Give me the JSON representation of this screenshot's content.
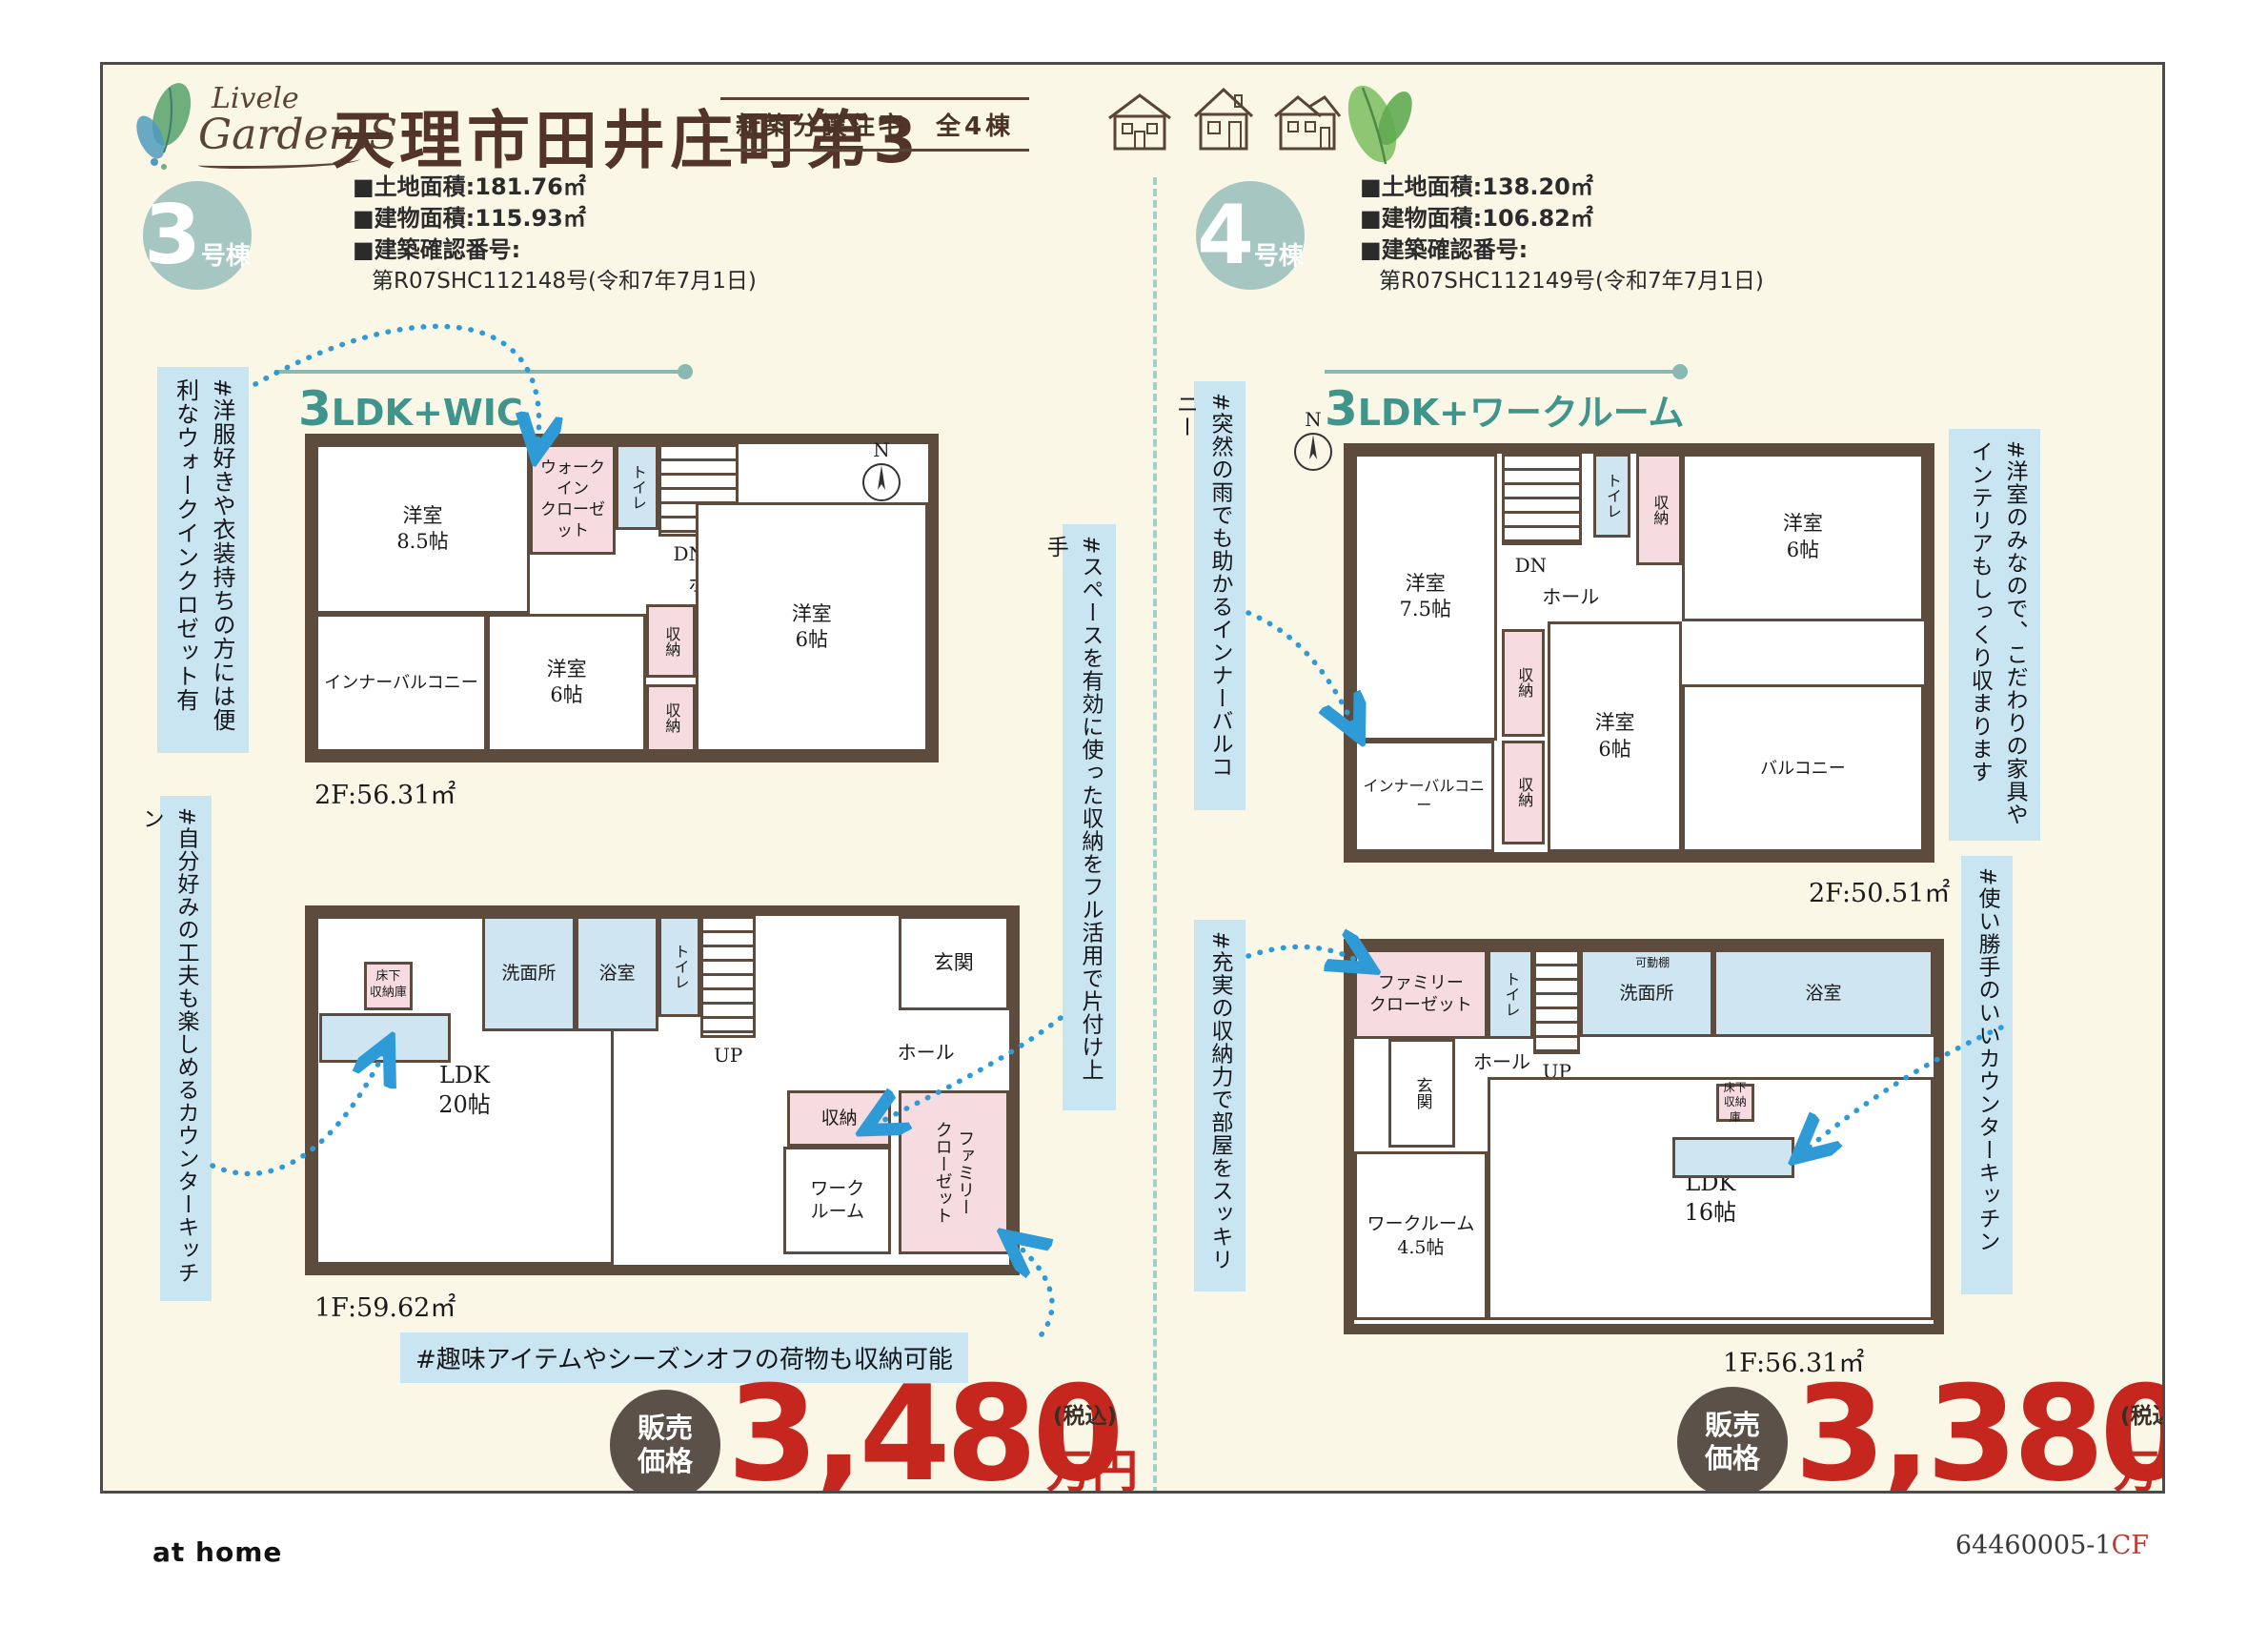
{
  "header": {
    "logo_line1": "Livele",
    "logo_line2": "Garden.S",
    "title": "天理市田井庄町第3",
    "badge": "新築分譲住宅　全4棟"
  },
  "house3": {
    "unit_number": "3",
    "unit_suffix": "号棟",
    "specs": [
      "■土地面積:181.76㎡",
      "■建物面積:115.93㎡",
      "■建築確認番号:",
      "第R07SHC112148号(令和7年7月1日)"
    ],
    "layout_num": "3",
    "layout_rest": "LDK+WIC",
    "floor2": {
      "area": "2F:56.31㎡",
      "compass": "N",
      "rooms": {
        "main": "洋室\n8.5帖",
        "wic": "ウォークイン\nクローゼット",
        "toilet": "トイレ",
        "dn": "DN",
        "hall": "ホール",
        "inner_balcony": "インナーバルコニー",
        "bed_mid": "洋室\n6帖",
        "storage1": "収納",
        "storage2": "収納",
        "bed_right": "洋室\n6帖"
      }
    },
    "floor1": {
      "area": "1F:59.62㎡",
      "rooms": {
        "ldk": "LDK\n20帖",
        "floor_storage": "床下\n収納庫",
        "washroom": "洗面所",
        "bath": "浴室",
        "toilet": "トイレ",
        "up": "UP",
        "hall": "ホール",
        "entrance": "玄関",
        "storage": "収納",
        "workroom": "ワーク\nルーム",
        "family_closet": "ファミリー\nクローゼット"
      }
    },
    "tags": {
      "left_top": "#洋服好きや衣装持ちの方には便利なウォークインクロゼット有",
      "left_bottom": "#自分好みの工夫も楽しめるカウンターキッチン",
      "right": "#スペースを有効に使った収納をフル活用で片付け上手",
      "bottom": "#趣味アイテムやシーズンオフの荷物も収納可能"
    },
    "price": {
      "label": "販売\n価格",
      "amount": "3,480",
      "tax": "(税込)",
      "unit": "万円"
    }
  },
  "house4": {
    "unit_number": "4",
    "unit_suffix": "号棟",
    "specs": [
      "■土地面積:138.20㎡",
      "■建物面積:106.82㎡",
      "■建築確認番号:",
      "第R07SHC112149号(令和7年7月1日)"
    ],
    "layout_num": "3",
    "layout_rest": "LDK+ワークルーム",
    "floor2": {
      "area": "2F:50.51㎡",
      "compass": "N",
      "rooms": {
        "main": "洋室\n7.5帖",
        "dn": "DN",
        "hall": "ホール",
        "toilet": "トイレ",
        "storage_top": "収納",
        "bed_tr": "洋室\n6帖",
        "storage_mid": "収納",
        "bed_mid": "洋室\n6帖",
        "storage_bottom": "収納",
        "inner_balcony": "インナーバルコニー",
        "balcony": "バルコニー"
      }
    },
    "floor1": {
      "area": "1F:56.31㎡",
      "rooms": {
        "family_closet": "ファミリー\nクローゼット",
        "toilet": "トイレ",
        "up": "UP",
        "washroom": "洗面所",
        "shelf": "可動棚",
        "bath": "浴室",
        "hall": "ホール",
        "entrance": "玄関",
        "workroom": "ワークルーム\n4.5帖",
        "ldk": "LDK\n16帖",
        "floor_storage": "床下\n収納庫"
      }
    },
    "tags": {
      "left_top": "#突然の雨でも助かるインナーバルコニー",
      "left_bottom": "#充実の収納力で部屋をスッキリ",
      "right_top": "#洋室のみなので、こだわりの家具やインテリアもしっくり収まります",
      "right_bottom": "#使い勝手のいいカウンターキッチン"
    },
    "price": {
      "label": "販売\n価格",
      "amount": "3,380",
      "tax": "(税込)",
      "unit": "万円"
    }
  },
  "footer": {
    "brand": "at home",
    "code_num": "64460005-1",
    "code_suffix": "CF"
  }
}
